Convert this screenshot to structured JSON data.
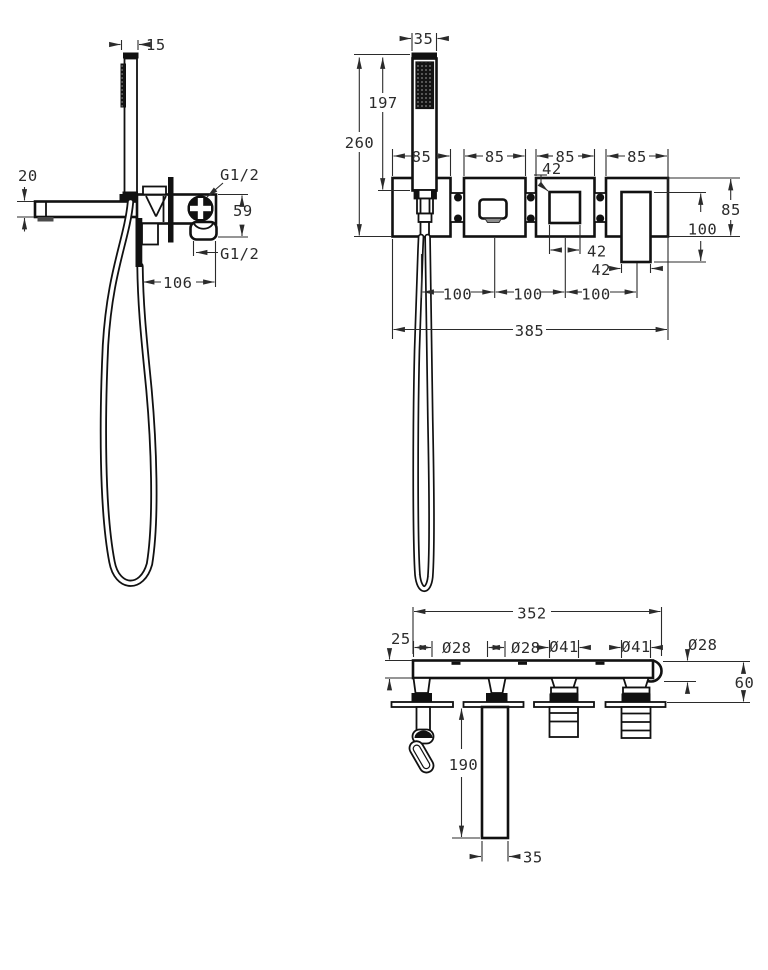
{
  "drawing": {
    "type": "technical-dimension-drawing",
    "subject": "wall-mounted bath shower mixer with hand shower",
    "colors": {
      "line": "#111111",
      "dimension": "#2b2b2b",
      "background": "#ffffff"
    }
  },
  "views": {
    "side": {
      "d15": "15",
      "d20": "20",
      "g12_top": "G1/2",
      "d59": "59",
      "g12_bottom": "G1/2",
      "d106": "106"
    },
    "front": {
      "d35": "35",
      "d197": "197",
      "d260": "260",
      "plate_widths": [
        "85",
        "85",
        "85",
        "85"
      ],
      "d42_knob_top": "42",
      "d85_right": "85",
      "d100_right": "100",
      "d42_knob": "42",
      "d42_handle": "42",
      "center_spacings": [
        "100",
        "100",
        "100"
      ],
      "d385": "385"
    },
    "top": {
      "d352": "352",
      "d25": "25",
      "diameters": [
        "Ø28",
        "Ø28",
        "Ø41",
        "Ø41",
        "Ø28"
      ],
      "d60": "60",
      "d190": "190",
      "d35": "35"
    }
  }
}
